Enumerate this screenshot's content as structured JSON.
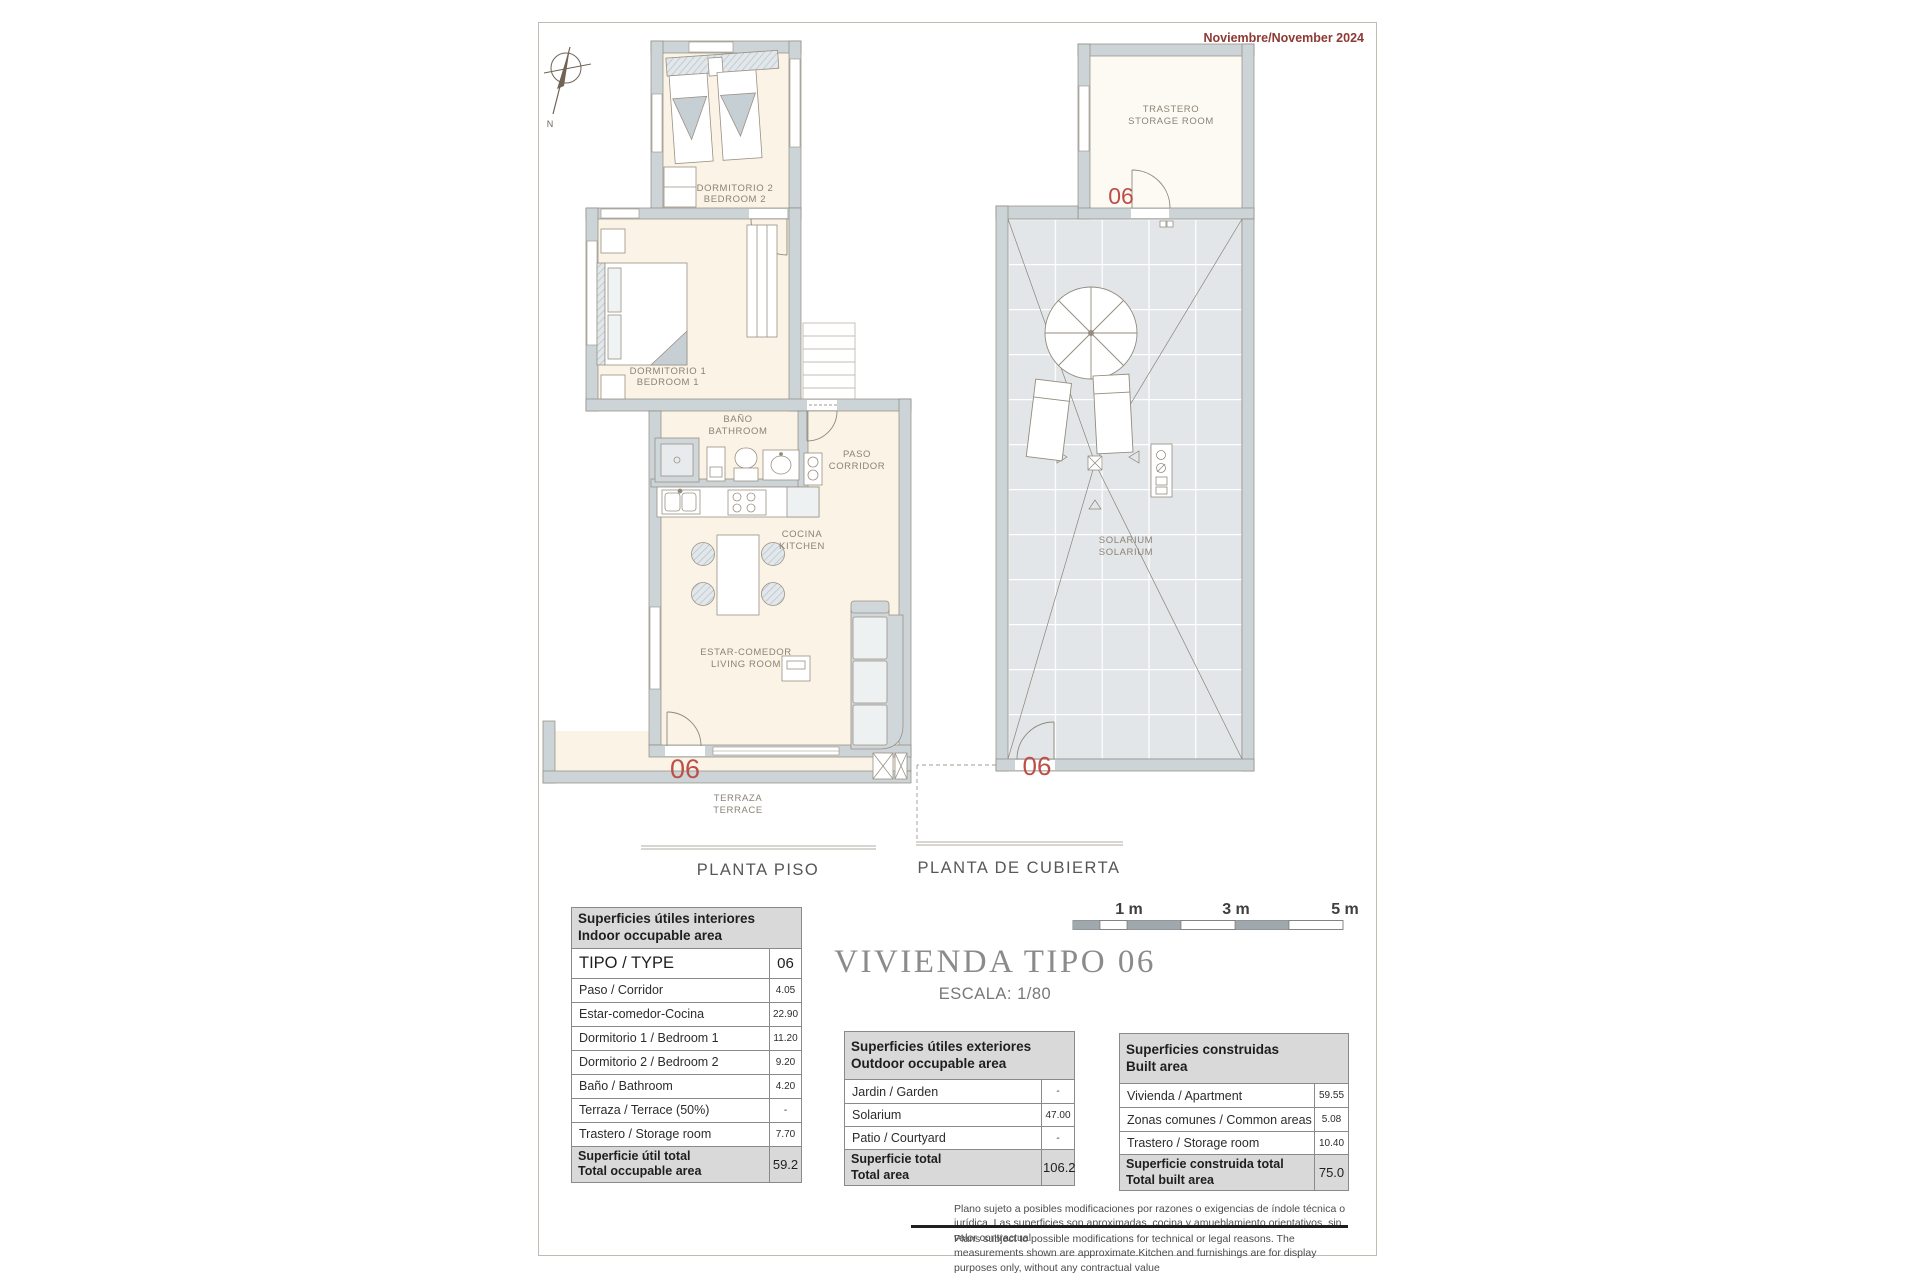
{
  "colors": {
    "accent_red": "#bd4f47",
    "date_red": "#8d3a33",
    "wall_gray": "#ccd4d8",
    "floor_cream": "#faf3e6"
  },
  "header": {
    "date": "Noviembre/November 2024"
  },
  "compass": {
    "north": "N"
  },
  "floor_plan": {
    "caption": "PLANTA PISO",
    "unit": "06",
    "rooms": {
      "bedroom2_es": "DORMITORIO 2",
      "bedroom2_en": "BEDROOM 2",
      "bedroom1_es": "DORMITORIO 1",
      "bedroom1_en": "BEDROOM 1",
      "bathroom_es": "BAÑO",
      "bathroom_en": "BATHROOM",
      "corridor_es": "PASO",
      "corridor_en": "CORRIDOR",
      "kitchen_es": "COCINA",
      "kitchen_en": "KITCHEN",
      "living_es": "ESTAR-COMEDOR",
      "living_en": "LIVING ROOM",
      "terrace_es": "TERRAZA",
      "terrace_en": "TERRACE"
    }
  },
  "roof_plan": {
    "caption": "PLANTA DE CUBIERTA",
    "unit": "06",
    "rooms": {
      "storage_es": "TRASTERO",
      "storage_en": "STORAGE ROOM",
      "solarium_es": "SOLARIUM",
      "solarium_en": "SOLARIUM"
    }
  },
  "title_block": {
    "title": "VIVIENDA TIPO 06",
    "scale": "ESCALA: 1/80"
  },
  "scale_bar": {
    "labels": [
      "1 m",
      "3 m",
      "5 m"
    ]
  },
  "tables": {
    "interior": {
      "title_es": "Superficies útiles interiores",
      "title_en": "Indoor occupable area",
      "type_label": "TIPO / TYPE",
      "type_value": "06",
      "rows": [
        {
          "label": "Paso / Corridor",
          "value": "4.05"
        },
        {
          "label": "Estar-comedor-Cocina",
          "value": "22.90"
        },
        {
          "label": "Dormitorio 1 / Bedroom 1",
          "value": "11.20"
        },
        {
          "label": "Dormitorio 2 / Bedroom 2",
          "value": "9.20"
        },
        {
          "label": "Baño / Bathroom",
          "value": "4.20"
        },
        {
          "label": "Terraza / Terrace (50%)",
          "value": "-"
        },
        {
          "label": "Trastero / Storage room",
          "value": "7.70"
        }
      ],
      "total_es": "Superficie útil total",
      "total_en": "Total occupable area",
      "total_value": "59.2"
    },
    "exterior": {
      "title_es": "Superficies útiles exteriores",
      "title_en": "Outdoor occupable area",
      "rows": [
        {
          "label": "Jardin / Garden",
          "value": "-"
        },
        {
          "label": "Solarium",
          "value": "47.00"
        },
        {
          "label": "Patio / Courtyard",
          "value": "-"
        }
      ],
      "total_es": "Superficie total",
      "total_en": "Total area",
      "total_value": "106.2"
    },
    "built": {
      "title_es": "Superficies construidas",
      "title_en": "Built area",
      "rows": [
        {
          "label": "Vivienda / Apartment",
          "value": "59.55"
        },
        {
          "label": "Zonas comunes / Common areas",
          "value": "5.08"
        },
        {
          "label": "Trastero / Storage room",
          "value": "10.40"
        }
      ],
      "total_es": "Superficie construida total",
      "total_en": "Total built area",
      "total_value": "75.0"
    }
  },
  "disclaimer": {
    "es": "Plano sujeto a posibles modificaciones por razones o exigencias de índole técnica o jurídica. Las superficies son aproximadas. cocina y amueblamiento  orientativos, sin valor contractual",
    "en": "Plans subject to possible modifications for technical or legal reasons. The measurements shown are approximate.Kitchen and furnishings are for display purposes only, without any contractual value"
  }
}
